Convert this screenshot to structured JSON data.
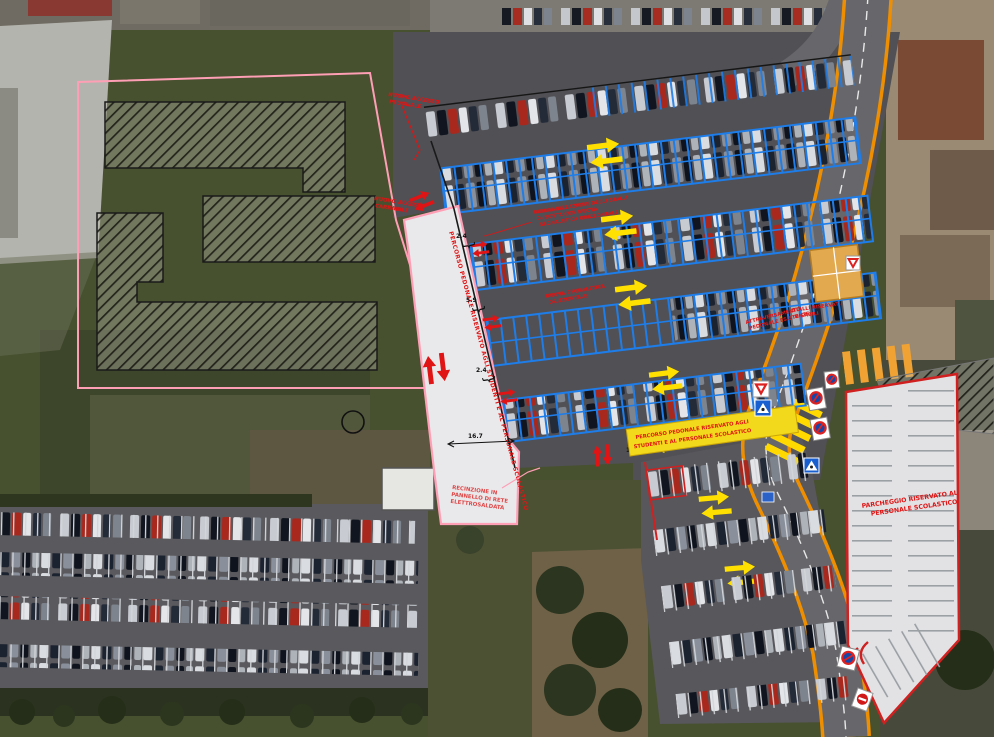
{
  "plan": {
    "title": "Site plan overlay on aerial photo - school parking reorganization",
    "labels": {
      "corridor": "PERCORSO PEDONALE RISERVATO AGLI STUDENTI E AL PERSONALE SCOLASTICO",
      "crosswalk": [
        "PERCORSO PEDONALE RISERVATO AGLI",
        "STUDENTI E AL PERSONALE SCOLASTICO"
      ],
      "staff_parking": [
        "PARCHEGGIO RISERVATO AL",
        "PERSONALE SCOLASTICO"
      ],
      "fence": [
        "RECINZIONE IN",
        "PANNELLO DI RETE",
        "ELETTROSALDATA"
      ],
      "access_ped": [
        "NUOVO ACCESSO",
        "PEDONALE"
      ],
      "access_car": [
        "NUOVO ACCESSO",
        "CARRABILE"
      ],
      "restripe": [
        "RIORGANIZZAZIONE DEGLI STALLI",
        "DI SOSTA CON NUOVA",
        "SEGNALETICA ORIZZONTALE"
      ],
      "new_marking": [
        "NUOVA SEGNALETICA",
        "ORIZZONTALE"
      ],
      "crossing_exist": [
        "ATTRAVERSAMENTO",
        "PEDONALE ESISTENTE"
      ],
      "reserved_stalls": [
        "STALLI RISERVATI",
        "DISABILI"
      ]
    },
    "dimensions": {
      "stall_a": "2.4",
      "aisle": "5.9",
      "stall_b": "2.4",
      "corridor": "16.7",
      "path": "1.5"
    },
    "icons": {
      "yield": "yield-sign",
      "no_parking": "no-parking-sign",
      "no_entry": "no-entry-sign",
      "pedestrian_crossing": "pedestrian-crossing-sign",
      "double_arrow": "two-way-circulation-arrow"
    },
    "colors": {
      "stall_blue": "#1e7de8",
      "plan_pink": "#ff9fb5",
      "annotation_red": "#e01414",
      "arrow_yellow": "#ffe000",
      "corridor_yellow": "#f2d91c",
      "road_edge_orange": "#ef8f00",
      "reserved_stall_orange": "#e2a94f",
      "staff_outline_red": "#d02020"
    }
  }
}
